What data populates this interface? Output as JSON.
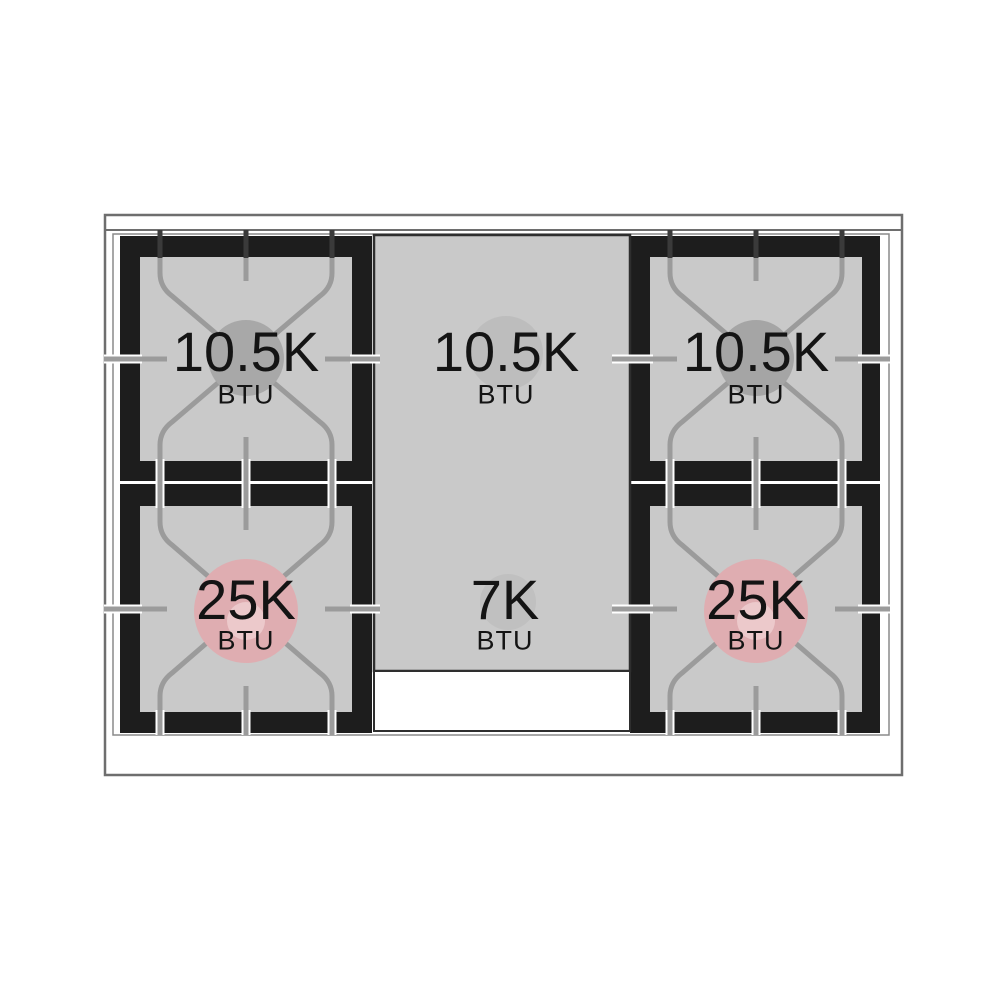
{
  "diagram": {
    "type": "range-cooktop-top-view",
    "burners": [
      {
        "position": "top-left",
        "value": "10.5K",
        "unit": "BTU"
      },
      {
        "position": "top-center",
        "value": "10.5K",
        "unit": "BTU"
      },
      {
        "position": "top-right",
        "value": "10.5K",
        "unit": "BTU"
      },
      {
        "position": "bottom-left",
        "value": "25K",
        "unit": "BTU"
      },
      {
        "position": "bottom-center",
        "value": "7K",
        "unit": "BTU"
      },
      {
        "position": "bottom-right",
        "value": "25K",
        "unit": "BTU"
      }
    ],
    "colors": {
      "surface_gray": "#c9c9c9",
      "grate_black": "#1d1d1d",
      "grate_line_gray": "#9b9b9b",
      "standard_burner_gray": "#a8a8a8",
      "high_power_pink": "#dfadb1",
      "high_power_inner_pink": "#ecc9cb"
    }
  }
}
